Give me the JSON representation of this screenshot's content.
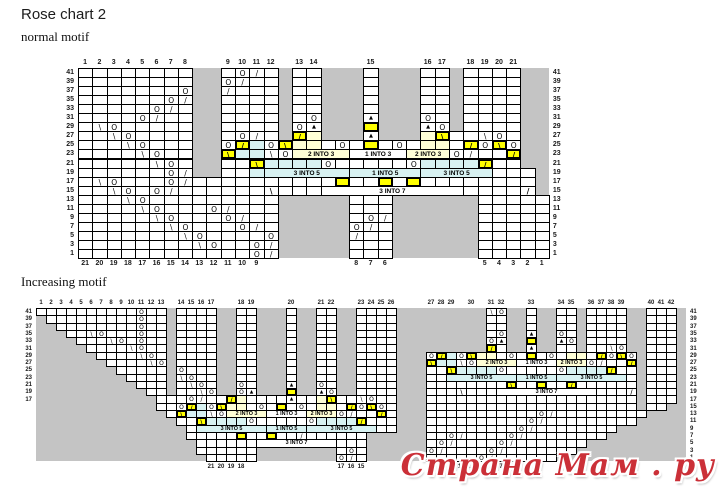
{
  "title": "Rose chart 2",
  "watermark": "Страна Мам . ру",
  "colors": {
    "grid_gray": "#c4c4c4",
    "cell_white": "#ffffff",
    "highlight_yellow": "#ffff00",
    "band_cyan": "#d8f2f2",
    "band_cream": "#ffffd6",
    "watermark_red": "#cb3038",
    "border": "#000000"
  },
  "symbol_legend": {
    "O": "yarn over",
    "/": "knit 2 together",
    "\\": "ssk",
    "A": "double decrease (triangle)",
    "K": "bold left decrease",
    "J": "bold right decrease",
    "yellow cells": "highlighted stitches",
    "cyan/cream bands": "N INTO M gather/increase cells",
    "#": "gray no-stitch area"
  },
  "charts": [
    {
      "name": "normal motif",
      "x": 78,
      "y": 68,
      "cw": 14.27,
      "rh": 9.05,
      "cols": 33,
      "row_labels": [
        "41",
        "39",
        "37",
        "35",
        "33",
        "31",
        "29",
        "27",
        "25",
        "23",
        "21",
        "19",
        "17",
        "15",
        "13",
        "11",
        "9",
        "7",
        "5",
        "3",
        "1"
      ],
      "left_labels_count": 21,
      "top_labels": [
        {
          "t": "1",
          "c": 1
        },
        {
          "t": "2",
          "c": 2
        },
        {
          "t": "3",
          "c": 3
        },
        {
          "t": "4",
          "c": 4
        },
        {
          "t": "5",
          "c": 5
        },
        {
          "t": "6",
          "c": 6
        },
        {
          "t": "7",
          "c": 7
        },
        {
          "t": "8",
          "c": 8
        },
        {
          "t": "9",
          "c": 11
        },
        {
          "t": "10",
          "c": 12
        },
        {
          "t": "11",
          "c": 13
        },
        {
          "t": "12",
          "c": 14
        },
        {
          "t": "13",
          "c": 16
        },
        {
          "t": "14",
          "c": 17
        },
        {
          "t": "15",
          "c": 21
        },
        {
          "t": "16",
          "c": 25
        },
        {
          "t": "17",
          "c": 26
        },
        {
          "t": "18",
          "c": 28
        },
        {
          "t": "19",
          "c": 29
        },
        {
          "t": "20",
          "c": 30
        },
        {
          "t": "21",
          "c": 31
        }
      ],
      "bottom_labels": [
        {
          "t": "21",
          "c": 1
        },
        {
          "t": "20",
          "c": 2
        },
        {
          "t": "19",
          "c": 3
        },
        {
          "t": "18",
          "c": 4
        },
        {
          "t": "17",
          "c": 5
        },
        {
          "t": "16",
          "c": 6
        },
        {
          "t": "15",
          "c": 7
        },
        {
          "t": "14",
          "c": 8
        },
        {
          "t": "13",
          "c": 9
        },
        {
          "t": "12",
          "c": 10
        },
        {
          "t": "11",
          "c": 11
        },
        {
          "t": "10",
          "c": 12
        },
        {
          "t": "9",
          "c": 13
        },
        {
          "t": "8",
          "c": 20
        },
        {
          "t": "7",
          "c": 21
        },
        {
          "t": "6",
          "c": 22
        },
        {
          "t": "5",
          "c": 29
        },
        {
          "t": "4",
          "c": 30
        },
        {
          "t": "3",
          "c": 31
        },
        {
          "t": "2",
          "c": 32
        },
        {
          "t": "1",
          "c": 33
        }
      ],
      "rows": [
        "........##.O/.#..###.###..#....##",
        "........##O/..#..###.###..#....##",
        ".......O##/...#..###.###..#....##",
        "......O/##....#..###.###..#....##",
        ".....O/.##....#..###.###..#....##",
        "....O/..##....#.O###A###O.#....##",
        ".\\O.....##....#OA###y###AO#....##",
        "..\\O....##.O/.#ue###A###et..\\O.##",
        "...\\O...##OjcOkee.O.y.O.ee.jOkO##",
        "....\\O..##kcc\\Oeeee....eeeO/..j##",
        ".....\\O.##..tccccO.....Occccu..##",
        "......O/##..ccccccccccccccccc...#",
        ".\\O...O/..........y..y.y........#",
        "..\\O.O/......K.................J#",
        "...\\O.........#####...######.....",
        "....\\O...O/...#####...######.....",
        ".....\\O...O/..#####.O/######.....",
        "......\\O...O/.#####O/.######.....",
        ".......\\O....O#####/..######.....",
        "........\\O..O/#####...######.....",
        "............O/#####...######....."
      ],
      "overlays": [
        {
          "r": 23,
          "c": 16,
          "s": 4,
          "t": "2 INTO 3",
          "bg": "e"
        },
        {
          "r": 23,
          "c": 20,
          "s": 4,
          "t": "1 INTO 3",
          "bg": "w"
        },
        {
          "r": 23,
          "c": 24,
          "s": 3,
          "t": "2 INTO 3",
          "bg": "e"
        },
        {
          "r": 19,
          "c": 14,
          "s": 6,
          "t": "3 INTO 5",
          "bg": "c"
        },
        {
          "r": 19,
          "c": 20,
          "s": 5,
          "t": "1 INTO 5",
          "bg": "c"
        },
        {
          "r": 19,
          "c": 25,
          "s": 5,
          "t": "3 INTO 5",
          "bg": "c"
        },
        {
          "r": 15,
          "c": 18,
          "s": 10,
          "t": "3 INTO 7",
          "bg": "w"
        }
      ]
    },
    {
      "name": "Increasing motif",
      "x": 36,
      "y": 308,
      "cw": 10,
      "rh": 7.29,
      "cols": 65,
      "row_labels": [
        "41",
        "39",
        "37",
        "35",
        "33",
        "31",
        "29",
        "27",
        "25",
        "23",
        "21",
        "19",
        "17",
        "15",
        "13",
        "11",
        "9",
        "7",
        "5",
        "3",
        "1"
      ],
      "left_labels_count": 13,
      "top_labels": [
        {
          "t": "1",
          "c": 1
        },
        {
          "t": "2",
          "c": 2
        },
        {
          "t": "3",
          "c": 3
        },
        {
          "t": "4",
          "c": 4
        },
        {
          "t": "5",
          "c": 5
        },
        {
          "t": "6",
          "c": 6
        },
        {
          "t": "7",
          "c": 7
        },
        {
          "t": "8",
          "c": 8
        },
        {
          "t": "9",
          "c": 9
        },
        {
          "t": "10",
          "c": 10
        },
        {
          "t": "11",
          "c": 11
        },
        {
          "t": "12",
          "c": 12
        },
        {
          "t": "13",
          "c": 13
        },
        {
          "t": "14",
          "c": 15
        },
        {
          "t": "15",
          "c": 16
        },
        {
          "t": "16",
          "c": 17
        },
        {
          "t": "17",
          "c": 18
        },
        {
          "t": "18",
          "c": 21
        },
        {
          "t": "19",
          "c": 22
        },
        {
          "t": "20",
          "c": 26
        },
        {
          "t": "21",
          "c": 29
        },
        {
          "t": "22",
          "c": 30
        },
        {
          "t": "23",
          "c": 33
        },
        {
          "t": "24",
          "c": 34
        },
        {
          "t": "25",
          "c": 35
        },
        {
          "t": "26",
          "c": 36
        },
        {
          "t": "27",
          "c": 40
        },
        {
          "t": "28",
          "c": 41
        },
        {
          "t": "29",
          "c": 42
        },
        {
          "t": "30",
          "c": 44
        },
        {
          "t": "31",
          "c": 46
        },
        {
          "t": "32",
          "c": 47
        },
        {
          "t": "33",
          "c": 50
        },
        {
          "t": "34",
          "c": 53
        },
        {
          "t": "35",
          "c": 54
        },
        {
          "t": "36",
          "c": 56
        },
        {
          "t": "37",
          "c": 57
        },
        {
          "t": "38",
          "c": 58
        },
        {
          "t": "39",
          "c": 59
        },
        {
          "t": "40",
          "c": 62
        },
        {
          "t": "41",
          "c": 63
        },
        {
          "t": "42",
          "c": 64
        }
      ],
      "bottom_labels": [
        {
          "t": "21",
          "c": 18
        },
        {
          "t": "20",
          "c": 19
        },
        {
          "t": "19",
          "c": 20
        },
        {
          "t": "18",
          "c": 21
        },
        {
          "t": "17",
          "c": 31
        },
        {
          "t": "16",
          "c": 32
        },
        {
          "t": "15",
          "c": 33
        },
        {
          "t": "14",
          "c": 40
        },
        {
          "t": "13",
          "c": 41
        },
        {
          "t": "12",
          "c": 42
        },
        {
          "t": "11",
          "c": 43
        },
        {
          "t": "10",
          "c": 44
        },
        {
          "t": "9",
          "c": 45
        },
        {
          "t": "8",
          "c": 46
        },
        {
          "t": "7",
          "c": 47
        }
      ],
      "rows": [
        "..........O..#....##..###.##..##....#########\\O##.##..#....##...#",
        "#.........O..#....##..###.##..##....#########..##.##..#....##...#",
        "##........O..#....##..###.##..##....#########..##.##..#....##...#",
        "###..\\O...O..#....##..###.##..##....#########.O##A##O.#....##...#",
        "####...\\O.O..#....##..###.##..##....#########OA##y##AO#....##...#",
        "#####....\\O..#....##..###.##..##....#########u.##A##..#..\\O##...#",
        "######....\\O.#....##..###.##..##....###OjcOkee.O.y.O.ee.jOkO#...#",
        "#######....\\O#....##..###.##..##....###kcc\\Oeeee....eeeO/..j#...#",
        "########.....#O...##..###.##..##....###..tccccO.....Occccu..#...#",
        "#########....#\\O..##..###.##..##....###..cccccccccccccccccc.#...#",
        "##########...#.\\O.##O.###A##O.##....###........t..y..u......#...#",
        "###########..#..\\O##OA###y##AO##....###...K................J#...#",
        "############...O/..ue....A..et..\\O..###.....................#...#",
        "############..OjcOkee.O.y.O.ee.jOkO.###.....................#..##",
        "#############.kcc\\Oeeee....eeeO/..j.###...........O/.........####",
        "##############..tccccO.....Occccu...###..........O/.........#####",
        "###############.cccccccccccccccccc..###.........O/........#######",
        "###############.....y..y../......######..O/....O/........########",
        "################.................######.O/....O/.......##########",
        "################......########.O.######O/....O/.......###########",
        "#################.....########O/.######.....O/......#############"
      ],
      "overlays": [
        {
          "r": 13,
          "c": 20,
          "s": 4,
          "t": "2 INTO 3",
          "bg": "e"
        },
        {
          "r": 13,
          "c": 24,
          "s": 4,
          "t": "1 INTO 3",
          "bg": "w"
        },
        {
          "r": 13,
          "c": 28,
          "s": 3,
          "t": "2 INTO 3",
          "bg": "e"
        },
        {
          "r": 9,
          "c": 17,
          "s": 7,
          "t": "3 INTO 5",
          "bg": "c"
        },
        {
          "r": 9,
          "c": 24,
          "s": 4,
          "t": "1 INTO 5",
          "bg": "c"
        },
        {
          "r": 9,
          "c": 28,
          "s": 7,
          "t": "3 INTO 5",
          "bg": "c"
        },
        {
          "r": 5,
          "c": 23,
          "s": 8,
          "t": "3 INTO 7",
          "bg": "w"
        },
        {
          "r": 27,
          "c": 45,
          "s": 4,
          "t": "2 INTO 3",
          "bg": "e"
        },
        {
          "r": 27,
          "c": 49,
          "s": 4,
          "t": "1 INTO 3",
          "bg": "w"
        },
        {
          "r": 27,
          "c": 53,
          "s": 3,
          "t": "2 INTO 3",
          "bg": "e"
        },
        {
          "r": 23,
          "c": 42,
          "s": 7,
          "t": "3 INTO 5",
          "bg": "c"
        },
        {
          "r": 23,
          "c": 49,
          "s": 4,
          "t": "1 INTO 5",
          "bg": "c"
        },
        {
          "r": 23,
          "c": 53,
          "s": 7,
          "t": "3 INTO 5",
          "bg": "c"
        },
        {
          "r": 19,
          "c": 47,
          "s": 10,
          "t": "3 INTO 7",
          "bg": "w"
        }
      ]
    }
  ]
}
